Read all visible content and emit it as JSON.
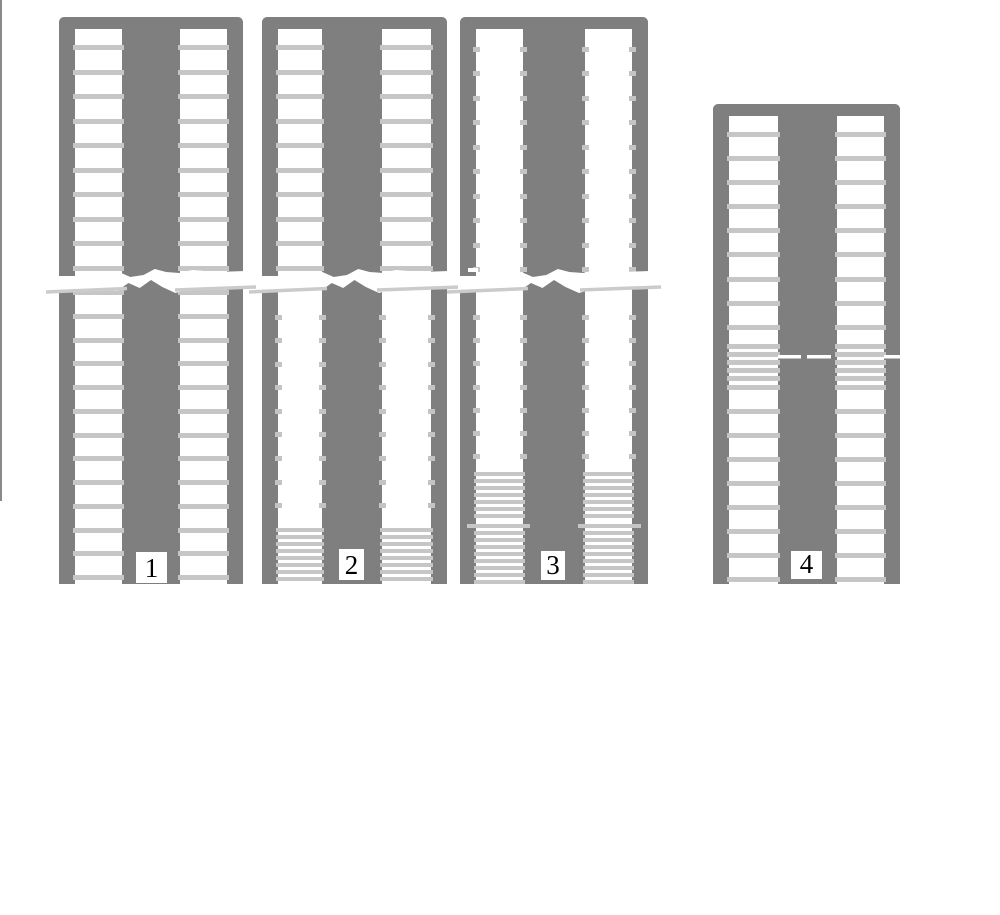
{
  "canvas": {
    "width": 1000,
    "height": 915,
    "background": "#ffffff"
  },
  "palette": {
    "frame_gray": "#7f7f7f",
    "rung_gray": "#c6c6c6",
    "stub_gray": "#c4c4c4",
    "tear_line_gray": "#cbcbcb",
    "label_bg": "#ffffff",
    "label_text": "#000000",
    "edge_line_gray": "#8a8a8a",
    "background": "#ffffff"
  },
  "edge_line": {
    "x": 0,
    "y": 0,
    "width": 2,
    "height": 501
  },
  "tear_profile": {
    "top": [
      [
        0,
        276
      ],
      [
        0.1,
        276
      ],
      [
        0.22,
        272
      ],
      [
        0.33,
        272
      ],
      [
        0.39,
        277
      ],
      [
        0.46,
        275
      ],
      [
        0.52,
        269
      ],
      [
        0.58,
        272
      ],
      [
        0.65,
        273
      ],
      [
        0.72,
        270
      ],
      [
        0.85,
        272
      ],
      [
        1,
        271
      ]
    ],
    "bottom": [
      [
        1,
        288
      ],
      [
        0.9,
        289
      ],
      [
        0.82,
        287
      ],
      [
        0.72,
        288
      ],
      [
        0.63,
        293
      ],
      [
        0.56,
        287
      ],
      [
        0.5,
        280
      ],
      [
        0.44,
        288
      ],
      [
        0.38,
        283
      ],
      [
        0.32,
        291
      ],
      [
        0.22,
        290
      ],
      [
        0.1,
        292
      ],
      [
        0,
        293
      ]
    ]
  },
  "figures": [
    {
      "label": "1",
      "x": 59,
      "width": 184,
      "top": 17,
      "bottom": 584,
      "cap_height": 12,
      "rail_width": 16,
      "column": {
        "x": 122,
        "width": 58
      },
      "rungs_full": [
        45,
        70,
        94,
        119,
        143,
        168,
        192,
        217,
        241,
        266,
        290,
        314,
        338,
        361,
        385,
        409,
        433,
        456,
        480,
        504,
        528,
        551,
        575
      ],
      "stub_rows": [],
      "dense_rungs": [],
      "break": {
        "style": "jagged-tear"
      },
      "label_box": {
        "x": 136,
        "y": 552,
        "w": 31,
        "h": 31
      }
    },
    {
      "label": "2",
      "x": 262,
      "width": 185,
      "top": 17,
      "bottom": 584,
      "cap_height": 12,
      "rail_width": 16,
      "column": {
        "x": 322,
        "width": 60
      },
      "rungs_full": [
        45,
        70,
        94,
        119,
        143,
        168,
        192,
        217,
        241,
        266
      ],
      "stub_rows": [
        315,
        338,
        362,
        385,
        409,
        432,
        456,
        480,
        503
      ],
      "dense_rungs": [
        528,
        535,
        542,
        549,
        556,
        563,
        570,
        577
      ],
      "break": {
        "style": "jagged-tear"
      },
      "label_box": {
        "x": 339,
        "y": 549,
        "w": 25,
        "h": 31
      }
    },
    {
      "label": "3",
      "x": 460,
      "width": 188,
      "top": 17,
      "bottom": 584,
      "cap_height": 12,
      "rail_width": 16,
      "column": {
        "x": 523,
        "width": 62
      },
      "rungs_full": [],
      "stub_rows": [
        47,
        71,
        96,
        120,
        145,
        169,
        194,
        218,
        243,
        267,
        315,
        338,
        361,
        385,
        408,
        431,
        454
      ],
      "dense_rungs": [
        472,
        479,
        486,
        493,
        500,
        507,
        514,
        531,
        538,
        545,
        552,
        559,
        566,
        573,
        580
      ],
      "offset_rung": 524,
      "rail_dash": {
        "x": 468,
        "y": 268,
        "w": 10,
        "h": 4
      },
      "break": {
        "style": "jagged-tear"
      },
      "label_box": {
        "x": 541,
        "y": 551,
        "w": 24,
        "h": 29
      }
    },
    {
      "label": "4",
      "x": 713,
      "width": 187,
      "top": 104,
      "bottom": 584,
      "cap_height": 12,
      "rail_width": 16,
      "column": {
        "x": 778,
        "width": 59
      },
      "rungs_full": [
        132,
        156,
        180,
        204,
        228,
        252,
        277,
        301,
        325,
        344,
        352,
        360,
        368,
        376,
        385,
        409,
        433,
        457,
        481,
        505,
        529,
        553,
        577
      ],
      "stub_rows": [],
      "dense_rungs": [],
      "break": {
        "style": "dashes",
        "y": 355,
        "h": 3.5,
        "dashes": [
          [
            778,
            801
          ],
          [
            807,
            831
          ],
          [
            884,
            903
          ]
        ]
      },
      "label_box": {
        "x": 791,
        "y": 551,
        "w": 31,
        "h": 28
      }
    }
  ]
}
